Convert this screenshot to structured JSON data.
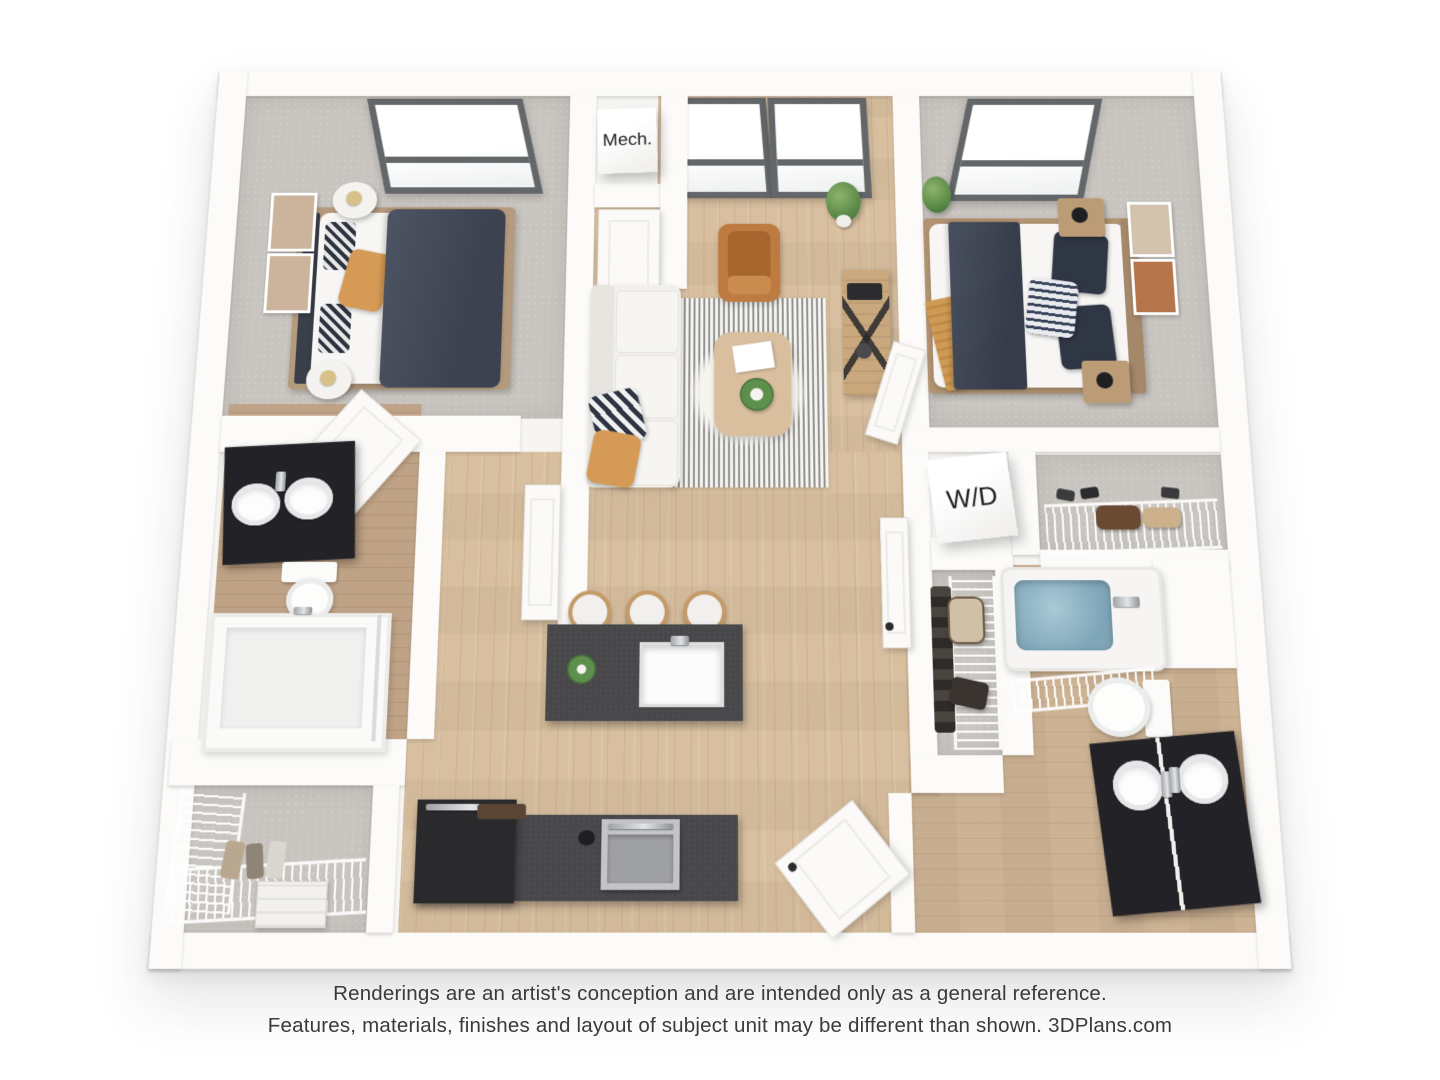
{
  "labels": {
    "mech_closet": "Mech.",
    "washer_dryer": "W/D"
  },
  "disclaimer": {
    "line1": "Renderings are an artist's conception and are intended only as a general reference.",
    "line2": "Features, materials, finishes and layout of subject unit may be different than shown. 3DPlans.com"
  },
  "palette": {
    "background": "#ffffff",
    "wall_white": "#fcfbf9",
    "carpet_gray": "#c8c4bf",
    "wood_light": "#d8bf9f",
    "wood_bath": "#cdb394",
    "cabinet_dark_gray": "#48484b",
    "vanity_black": "#232227",
    "sofa_white": "#f2f0ec",
    "armchair_cognac": "#bd7a41",
    "bed_navy": "#454b58",
    "accent_orange": "#d59a55",
    "plant_green": "#5b8a47",
    "tub_water": "#8fb7c7",
    "skylight_frame": "#63676a",
    "text_dark": "#3a3a3a"
  }
}
